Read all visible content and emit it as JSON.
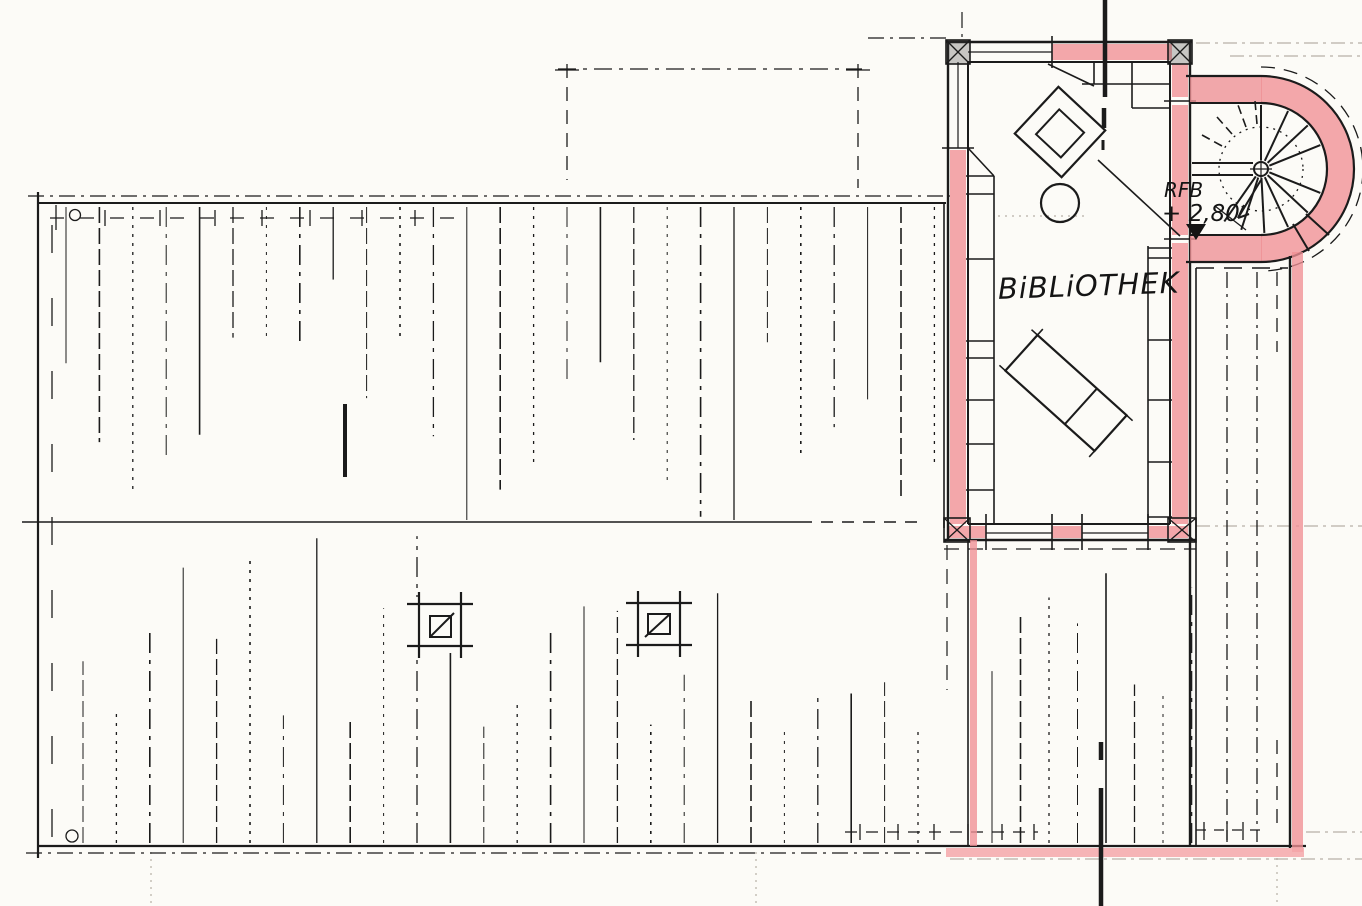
{
  "labels": {
    "room_name": "BiBLiOTHEK",
    "level_abbr": "RFB",
    "level_value": "+ 2,80"
  },
  "colors": {
    "paper": "#fcfbf7",
    "ink": "#1b1b1b",
    "wall_highlight": "#ef9095",
    "wall_highlight_light": "#f4a7aa",
    "guide": "#b7b1a7"
  }
}
